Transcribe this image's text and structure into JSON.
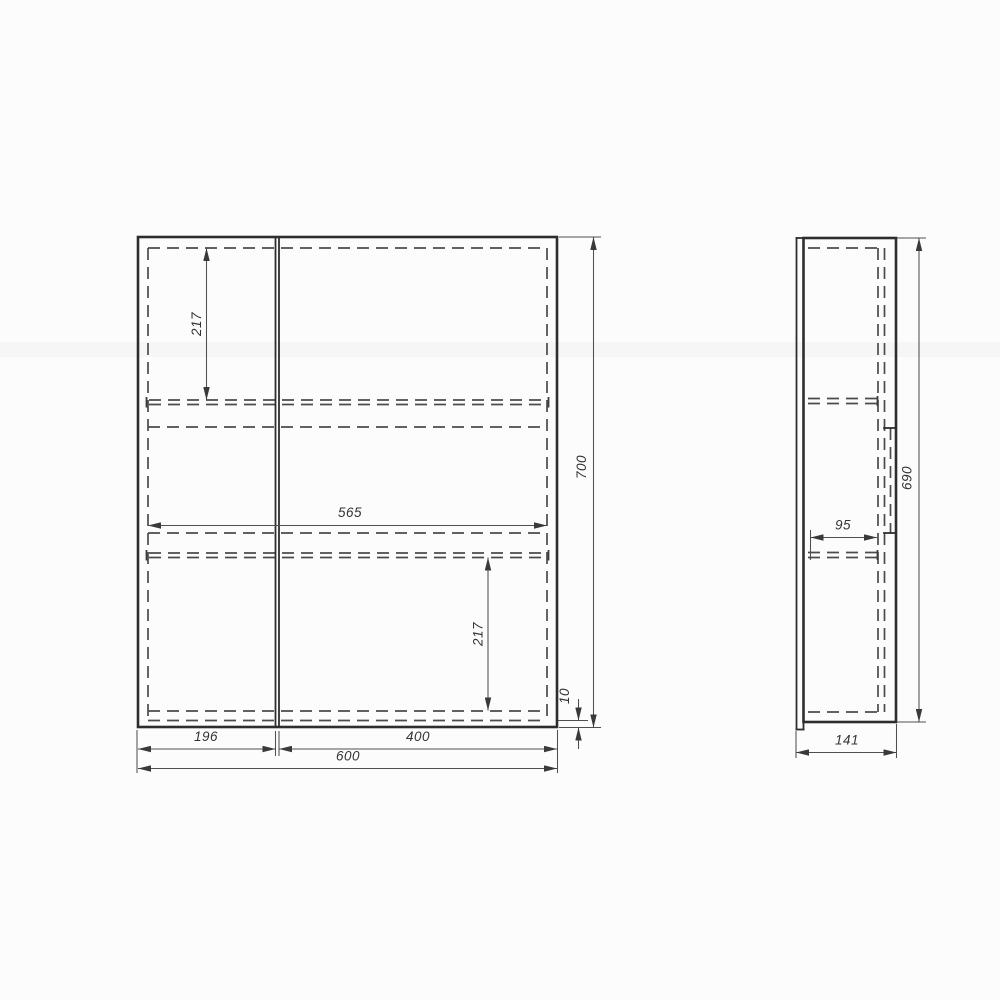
{
  "drawing": {
    "type": "technical-drawing",
    "subject": "two-door mirror cabinet, front and side orthographic views",
    "colors": {
      "background": "#fcfcfc",
      "visible_line": "#2d2d2d",
      "hidden_line": "#4b4b4b",
      "dimension_line": "#4f4f4f",
      "text": "#333333"
    },
    "views": {
      "front": {
        "dims": {
          "upper_shelf_offset": "217",
          "shelf_width": "565",
          "lower_shelf_offset": "217",
          "bottom_clearance": "10",
          "overall_height": "700",
          "left_door_width": "196",
          "right_door_width": "400",
          "overall_width": "600"
        }
      },
      "side": {
        "dims": {
          "shelf_depth": "95",
          "body_height": "690",
          "overall_depth": "141"
        }
      }
    }
  }
}
